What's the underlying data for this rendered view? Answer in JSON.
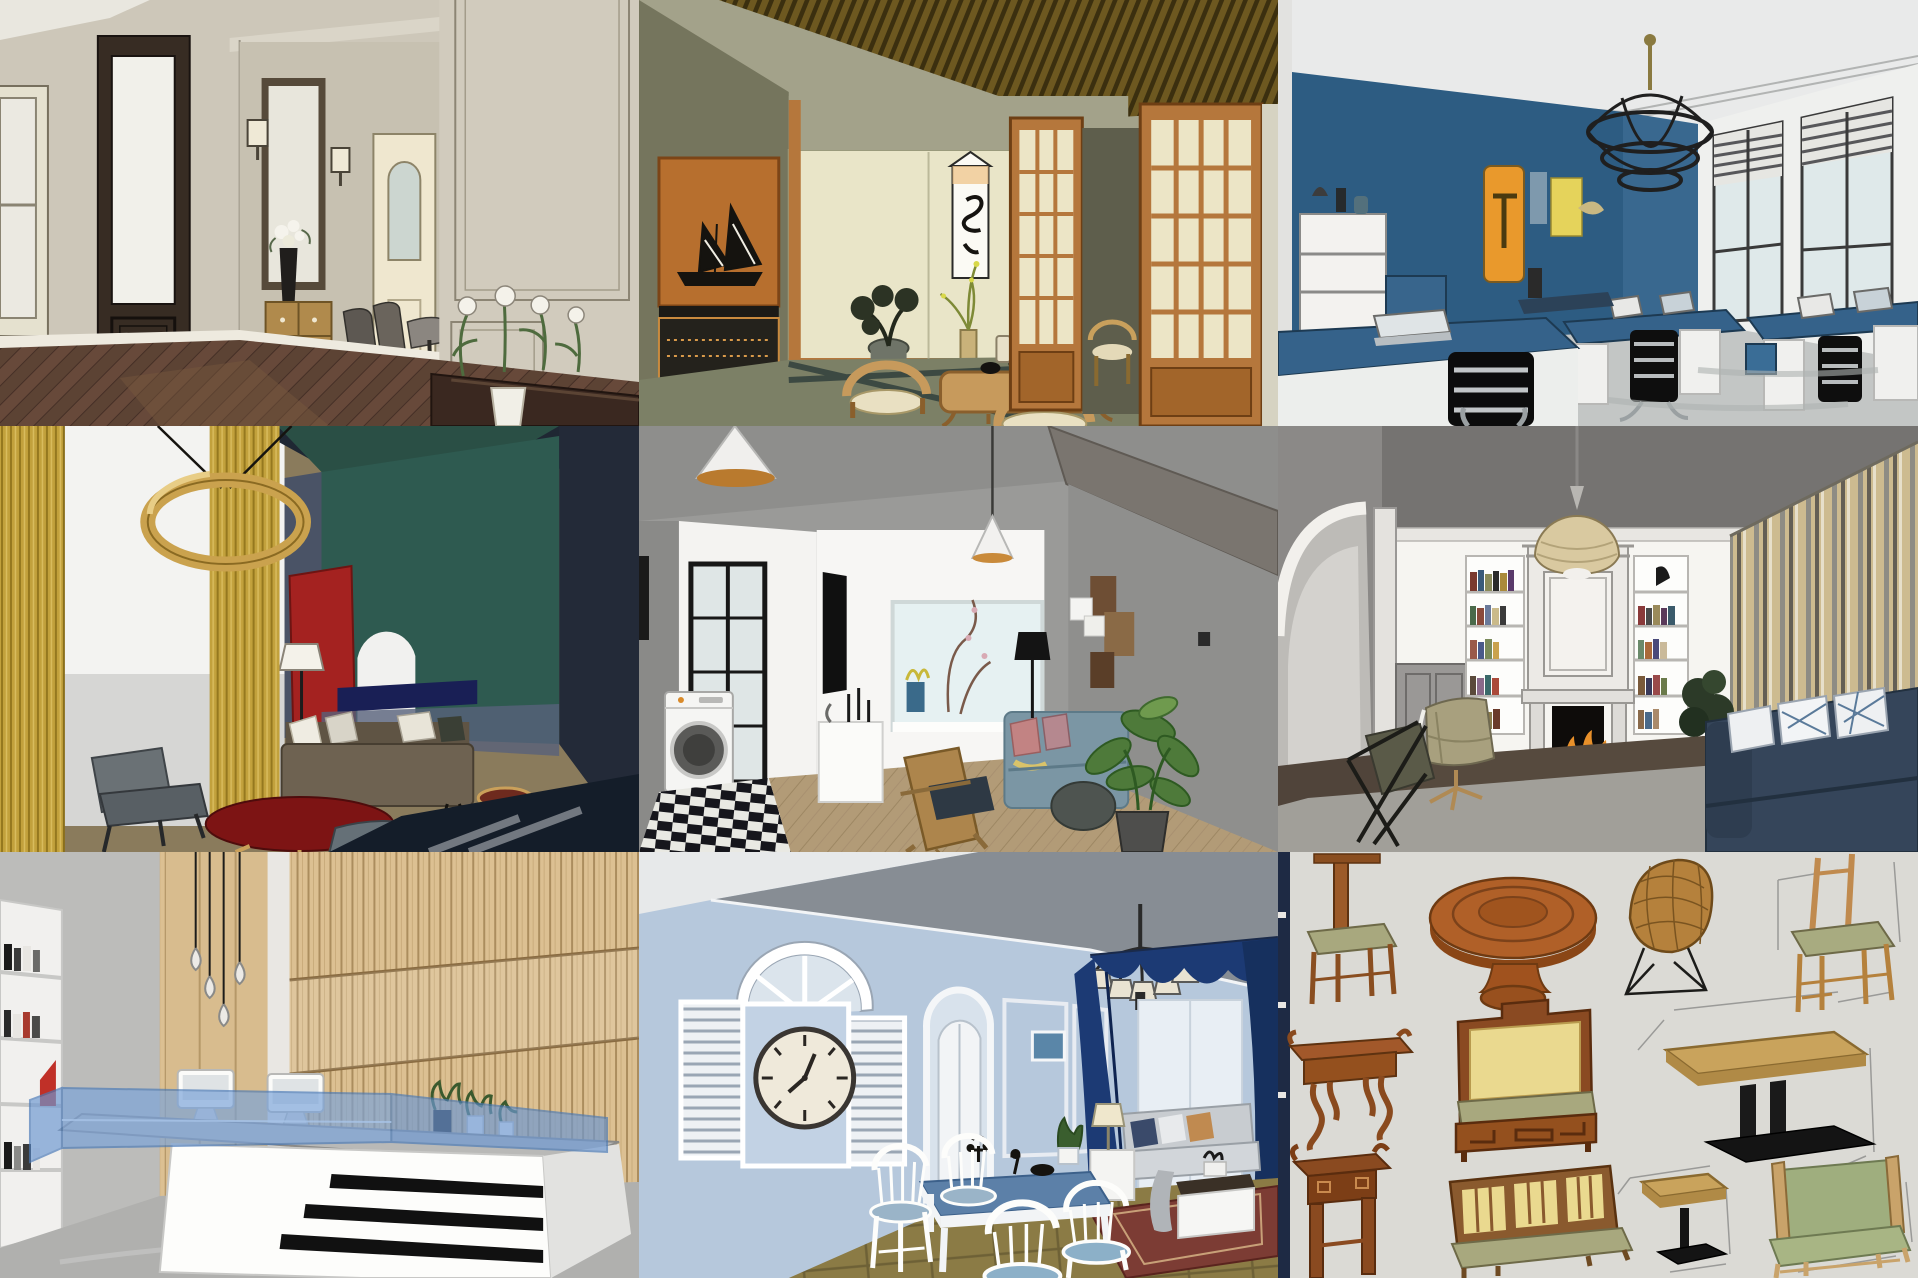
{
  "page": {
    "kind": "image-collage",
    "grid": "3x3",
    "label": "Collage of nine SketchUp interior design renders"
  },
  "panels": [
    {
      "id": "classic-hallway",
      "label": "Classic beige hallway: dark wood glazed door, wall moldings, mirror with sconces, wooden chest, dining chairs, white roses on console, herringbone floor",
      "accent": "#3b2f26"
    },
    {
      "id": "japanese-tea-room",
      "label": "Japanese tea room: slatted wood ceiling, orange alcove with ship model, calligraphy scroll, low tea table with curved chairs, tatami floor, shoji sliding doors",
      "accent": "#b5773c"
    },
    {
      "id": "blue-office",
      "label": "Blue office: dark blue accent wall with abstract art, ring cage chandelier, blue desks with laptops, black cantilever chairs, large windows, concrete floor",
      "accent": "#2e5d84"
    },
    {
      "id": "color-block-lounge",
      "label": "Color-block lounge: mustard curtains, wooden ring pendant, teal and navy walls, red panel, brown sofa, dark red oval coffee table, grey chairs",
      "accent": "#c5a33e"
    },
    {
      "id": "modern-apartment",
      "label": "Modern apartment: black framed laundry door with washing machine and checkered tile, cone pendants, TV wall, grey-blue sofa with pink pillows, monstera plant, wood floor",
      "accent": "#7b99a8"
    },
    {
      "id": "fireplace-library",
      "label": "Classic living room: ornate fireplace with fire, built-in bookshelves, rattan dome pendant, olive wing chair, navy sofa with lattice pillows, striped curtains",
      "accent": "#3b4a5e"
    },
    {
      "id": "reception-lobby",
      "label": "Reception lobby: wood slat feature wall, teardrop pendant bulbs, white angled desk with black stripes and blue glass top, two iMacs, bookshelf",
      "accent": "#7aa3d9"
    },
    {
      "id": "blue-dining-room",
      "label": "Mediterranean dining room: light blue walls, faux shuttered window with roman-numeral clock, arched doorway, navy curtains, chandelier, white dining set, oriental rug",
      "accent": "#b5c8dd"
    },
    {
      "id": "furniture-collection",
      "label": "Furniture model sheet: Chinese chairs, round pedestal table, wire chair, console and altar tables, throne bench, lattice bench, pedestal tables, green settee with dimension lines",
      "accent": "#9c5a28"
    }
  ]
}
